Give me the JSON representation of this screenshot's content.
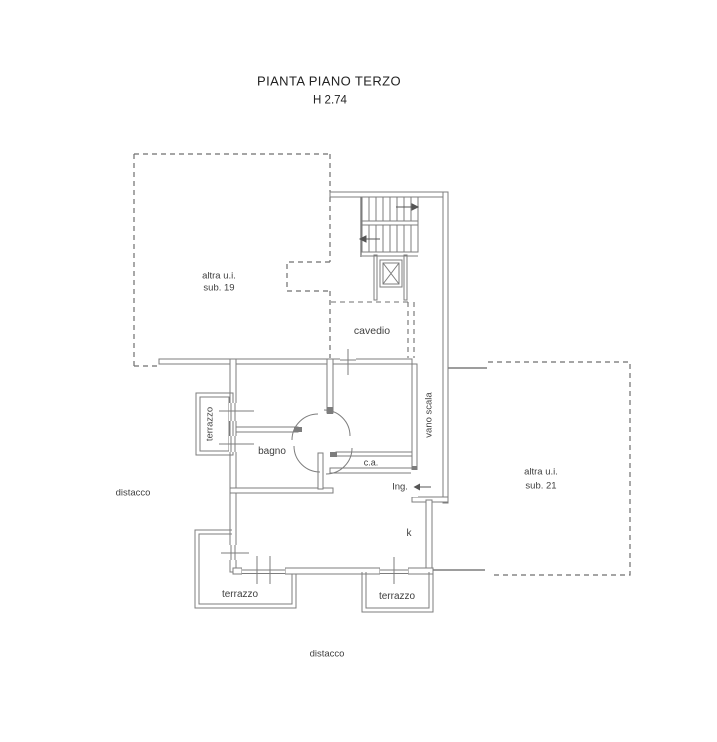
{
  "title": {
    "main": "PIANTA PIANO TERZO",
    "height": "H 2.74"
  },
  "areas": {
    "sub19_line1": "altra u.i.",
    "sub19_line2": "sub. 19",
    "sub21_line1": "altra u.i.",
    "sub21_line2": "sub. 21",
    "cavedio": "cavedio",
    "vano_scala": "vano scala",
    "terrazzo_left": "terrazzo",
    "terrazzo_bottom_left": "terrazzo",
    "terrazzo_bottom_right": "terrazzo",
    "bagno": "bagno",
    "ca": "c.a.",
    "ingresso": "Ing.",
    "kitchen": "k",
    "distacco_left": "distacco",
    "distacco_bottom": "distacco"
  },
  "colors": {
    "wall": "#7d7d7d",
    "dashed": "#6f6f6f",
    "text": "#3f3f3f",
    "background": "#ffffff"
  }
}
